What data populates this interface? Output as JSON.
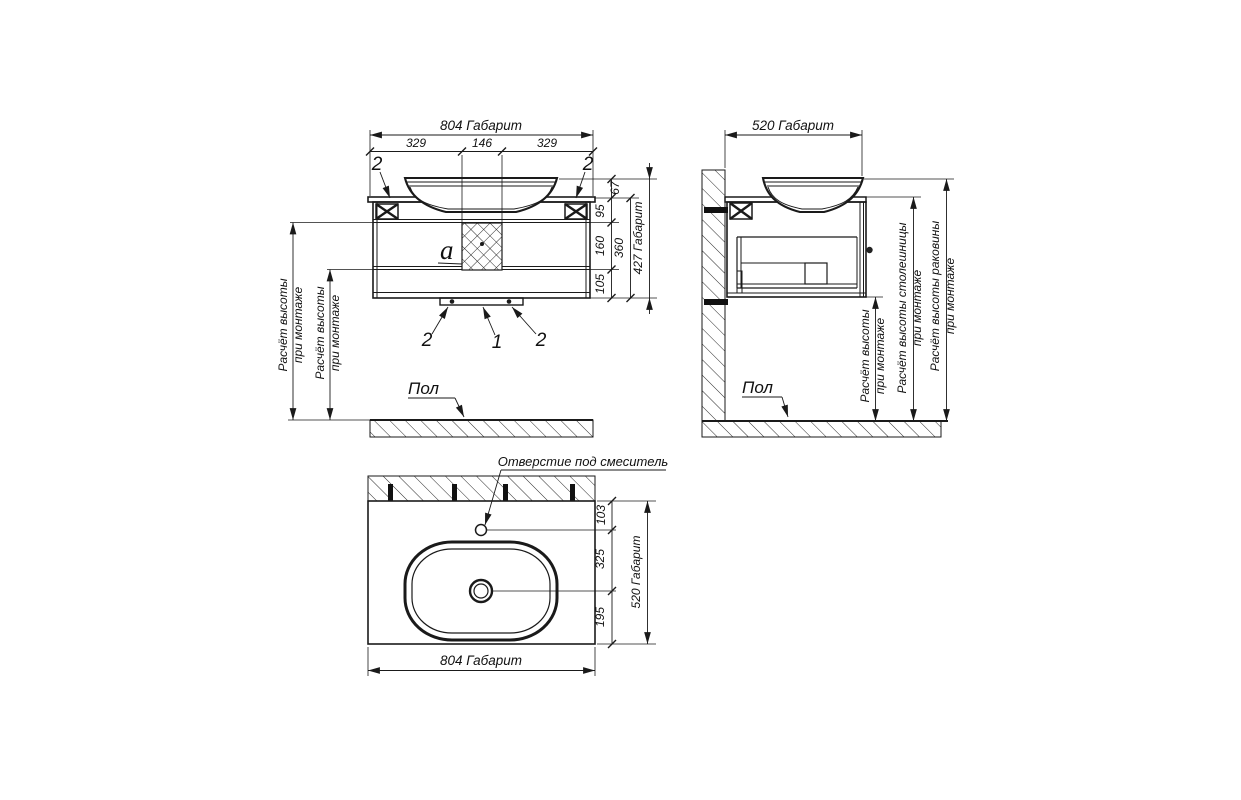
{
  "front_view": {
    "dim_width_total": "804 Габарит",
    "dim_width_left": "329",
    "dim_width_center": "146",
    "dim_width_right": "329",
    "dim_h_67": "67",
    "dim_h_95": "95",
    "dim_h_160": "160",
    "dim_h_105": "105",
    "dim_h_360": "360",
    "dim_h_total": "427 Габарит",
    "callout_bracket": "2",
    "callout_center": "1",
    "detail_label": "a",
    "height_note": {
      "line1": "Расчёт высоты",
      "line2": "при монтаже"
    },
    "floor_label": "Пол"
  },
  "side_view": {
    "dim_depth_total": "520 Габарит",
    "height_note": {
      "line1": "Расчёт высоты",
      "line2": "при монтаже"
    },
    "countertop_note": {
      "line1": "Расчёт высоты столешницы",
      "line2": "при монтаже"
    },
    "sink_note": {
      "line1": "Расчёт высоты раковины",
      "line2": "при монтаже"
    },
    "floor_label": "Пол"
  },
  "top_view": {
    "faucet_hole_label": "Отверстие под смеситель",
    "dim_103": "103",
    "dim_325": "325",
    "dim_195": "195",
    "dim_depth_total": "520 Габарит",
    "dim_width_total": "804 Габарит"
  },
  "colors": {
    "line": "#1a1a1a",
    "background": "#ffffff"
  }
}
